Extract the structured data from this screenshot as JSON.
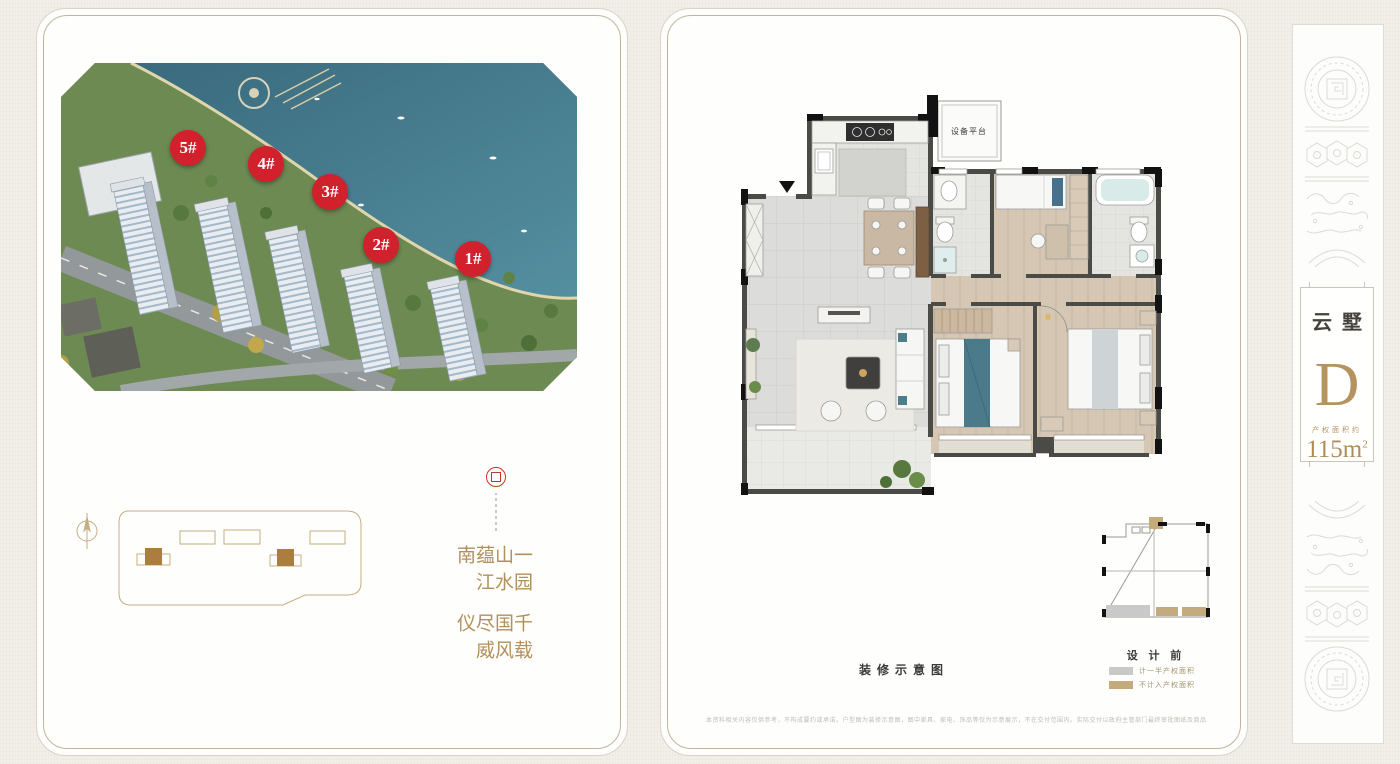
{
  "left_panel": {
    "photo_badges": [
      {
        "label": "5#"
      },
      {
        "label": "4#"
      },
      {
        "label": "3#"
      },
      {
        "label": "2#"
      },
      {
        "label": "1#"
      }
    ],
    "slogan": {
      "right_column": "一园山水蕴江南",
      "left_column": "千载国风尽威仪"
    }
  },
  "floor_plan": {
    "equipment_platform_label": "设备平台",
    "caption": "装修示意图"
  },
  "mini_plan": {
    "title": "设 计 前",
    "legend": [
      {
        "swatch_color": "#c9c9c9",
        "label": "计一半产权面积"
      },
      {
        "swatch_color": "#c3ab7e",
        "label": "不计入产权面积"
      }
    ]
  },
  "unit_card": {
    "series_name": "云墅",
    "unit_letter": "D",
    "area_label": "产权面积约",
    "area_value": "115m",
    "area_superscript": "2"
  },
  "disclaimer": "本资料相关内容仅供参考，不构成要约或承诺。户型图为装修示意图，图中家具、家电、饰品等仅为示意展示，不在交付范围内。实际交付以政府主管部门最终审批图纸及商品房买卖合同约定为准。产权面积以不动产登记机构实测登记为准，敬请留意。",
  "colors": {
    "accent_gold": "#b5935f",
    "badge_red": "#d0212d",
    "legend_gray": "#c9c9c9",
    "legend_tan": "#c3ab7e",
    "frame_tan": "#c3b59c",
    "wall_dark": "#3a3a38"
  },
  "icons": {
    "compass": "compass-rose-icon",
    "seal": "brand-seal-icon",
    "entry_arrow": "entry-direction-icon"
  }
}
